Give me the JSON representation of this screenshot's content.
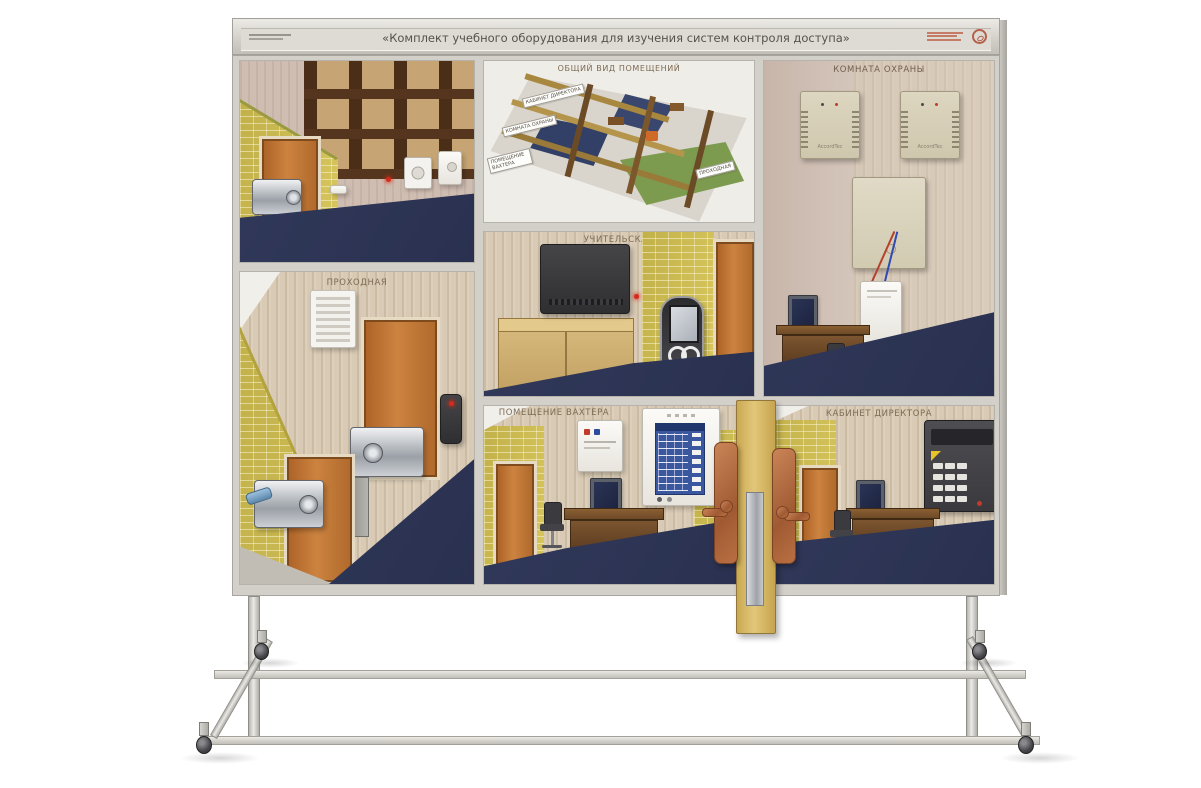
{
  "header": {
    "title": "«Комплект учебного оборудования для изучения систем контроля доступа»"
  },
  "sections": {
    "storage": {
      "label": "СКЛАД"
    },
    "overview": {
      "label": "ОБЩИЙ ВИД ПОМЕЩЕНИЙ",
      "map_labels": {
        "director": "КАБИНЕТ ДИРЕКТОРА",
        "security": "КОМНАТА ОХРАНЫ",
        "janitor": "ПОМЕЩЕНИЕ ВАХТЕРА",
        "entrance": "ПРОХОДНАЯ"
      }
    },
    "security_room": {
      "label": "КОМНАТА ОХРАНЫ",
      "psu_brand": "AccordTec"
    },
    "entrance_room": {
      "label": "ПРОХОДНАЯ"
    },
    "teachers_room": {
      "label": "УЧИТЕЛЬСКАЯ"
    },
    "janitor_room": {
      "label": "ПОМЕЩЕНИЕ ВАХТЕРА"
    },
    "director_office": {
      "label": "КАБИНЕТ ДИРЕКТОРА"
    }
  },
  "colors": {
    "frame_aluminium": "#d3d0ca",
    "brick_wall": "#c9b851",
    "door_orange": "#c07a38",
    "floor_blue": "#2e3452",
    "device_beige": "#d6cfb8",
    "copper_lock": "#b5714a",
    "title_text": "#55524c"
  }
}
